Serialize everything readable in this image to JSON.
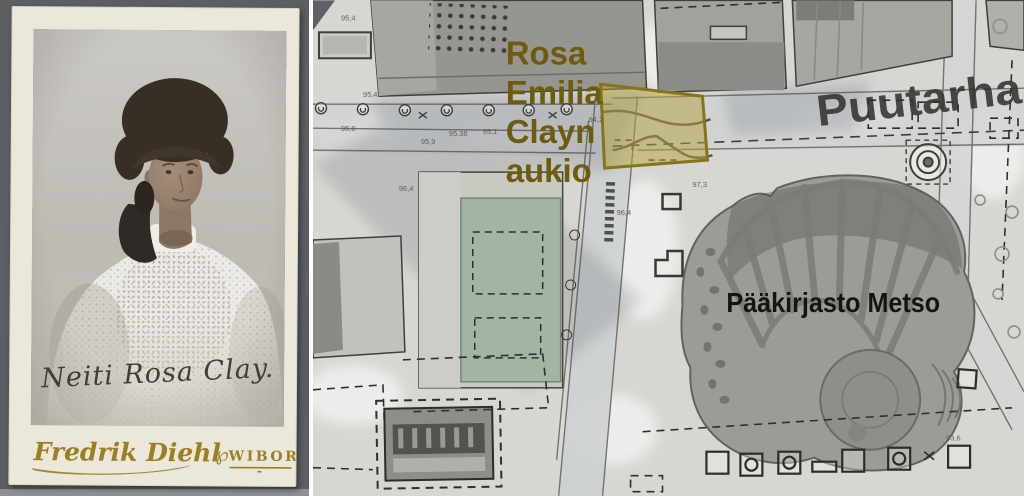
{
  "photo_panel": {
    "signature": "Neiti Rosa Clay.",
    "photographer": "Fredrik Diehl",
    "studio_ornament": "℘",
    "studio_city": "WIBORG"
  },
  "map_panel": {
    "square_label": {
      "lines": [
        "Rosa",
        "Emilia",
        "Clayn",
        "aukio"
      ],
      "color": "#6d5c0f"
    },
    "highlight": {
      "fill": "#b5a33c",
      "stroke": "#85741a"
    },
    "street_label": {
      "text": "Puutarha",
      "color": "#32322e"
    },
    "library_label": {
      "text": "Pääkirjasto Metso",
      "color": "#141412"
    },
    "elevations": [
      {
        "t": "95,4"
      },
      {
        "t": "95,4"
      },
      {
        "t": "95,8"
      },
      {
        "t": "95,9"
      },
      {
        "t": "95,36"
      },
      {
        "t": "95,1"
      },
      {
        "t": "94,2"
      },
      {
        "t": "96,4"
      },
      {
        "t": "96,4"
      },
      {
        "t": "97,3"
      },
      {
        "t": "93,6"
      }
    ]
  }
}
